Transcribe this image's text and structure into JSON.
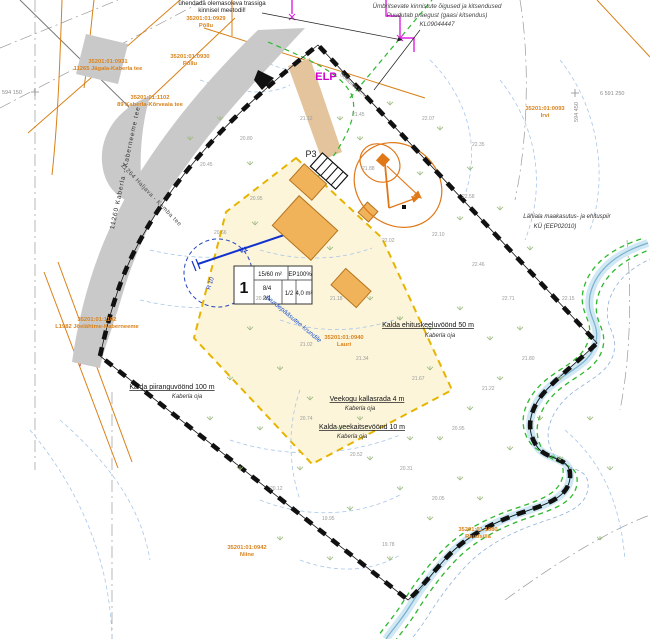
{
  "plan": {
    "colors": {
      "boundary": "#111111",
      "road_fill": "#c9c9c9",
      "building": "#f0b35a",
      "building_stroke": "#b5741f",
      "hoonestusala_fill": "#fcf5da",
      "hoonestusala_border": "#e6b400",
      "water": "#7ab0cc",
      "water_band": "#cfe8f4",
      "utility_green": "#2db82d",
      "cable_magenta": "#e020e0",
      "cadastral_orange": "#d9821c",
      "zone_red": "#cc2222",
      "connection_blue": "#1133cc"
    },
    "notes": {
      "top_l1": "ühendada olemasoleva trassiga",
      "top_l2": "kinnisel meetodil!",
      "right_l1": "Ümbritsevate kinnistute õigused ja kitsendused",
      "right_l2": "Puudutab praegust (gaasi kitsendus)",
      "right_l3": "KL09044447"
    },
    "labels": {
      "elp": "ELP",
      "p3": "P3",
      "v1": "V1",
      "r10": "R 10",
      "juurdepaas": "Juurdepääsutee krundile",
      "soidutee": "Sõidutee serv",
      "lahiala_l1": "Lähiala maakasutus- ja ehituspiir",
      "lahiala_l2": "KÜ (EEP02010)"
    },
    "roads": {
      "vertical": "11260 Kaberla - Kaberneeme tee",
      "diagonal": "11264 Haljava - Kemba tee"
    },
    "zones": [
      {
        "title": "Kalda piiranguvöönd 100 m",
        "sub": "Kaberla oja"
      },
      {
        "title": "Kalda ehituskeeluvöönd 50 m",
        "sub": "Kaberla oja"
      },
      {
        "title": "Veekogu kallasrada 4 m",
        "sub": "Kaberla oja"
      },
      {
        "title": "Kalda veekaitsevöönd 10 m",
        "sub": "Kaberla oja"
      }
    ],
    "cadastral": [
      {
        "line1": "35201:01:0931",
        "line2": "11265 Jägala-Kaberla tee"
      },
      {
        "line1": "35201:01:0929",
        "line2": "Põllu"
      },
      {
        "line1": "35201:01:0930",
        "line2": "Põllu"
      },
      {
        "line1": "35201:01:1102",
        "line2": "89 Kaberla-Kõrveaia tee"
      },
      {
        "line1": "35201:01:1102",
        "line2": "L1982 Jõelähtme-Kaberneeme"
      },
      {
        "line1": "35201:01:0942",
        "line2": "Niine"
      },
      {
        "line1": "35201:01:0093",
        "line2": "Irvi"
      },
      {
        "line1": "35201:01:1080",
        "line2": "Raudsilla"
      },
      {
        "line1": "35201:01:0940",
        "line2": "Lauri"
      }
    ],
    "coords": {
      "x_right": "6 591 250",
      "y_right": "594 450",
      "y_left": "594 150"
    },
    "plot_table": {
      "pos": "1",
      "area": "15/60 m²",
      "ep": "EP100%",
      "v1": "8/4",
      "v2": "2/1",
      "v3": "1/2",
      "v4": "4,0 m²"
    },
    "elevations": [
      {
        "x": 300,
        "y": 120,
        "v": "21.12"
      },
      {
        "x": 352,
        "y": 116,
        "v": "21.45"
      },
      {
        "x": 422,
        "y": 120,
        "v": "22.07"
      },
      {
        "x": 472,
        "y": 146,
        "v": "22.35"
      },
      {
        "x": 362,
        "y": 170,
        "v": "21.88"
      },
      {
        "x": 432,
        "y": 236,
        "v": "22.10"
      },
      {
        "x": 472,
        "y": 266,
        "v": "22.46"
      },
      {
        "x": 502,
        "y": 300,
        "v": "22.71"
      },
      {
        "x": 250,
        "y": 200,
        "v": "20.95"
      },
      {
        "x": 214,
        "y": 234,
        "v": "20.66"
      },
      {
        "x": 256,
        "y": 300,
        "v": "20.88"
      },
      {
        "x": 300,
        "y": 346,
        "v": "21.02"
      },
      {
        "x": 356,
        "y": 360,
        "v": "21.34"
      },
      {
        "x": 412,
        "y": 380,
        "v": "21.67"
      },
      {
        "x": 300,
        "y": 420,
        "v": "20.74"
      },
      {
        "x": 350,
        "y": 456,
        "v": "20.52"
      },
      {
        "x": 400,
        "y": 470,
        "v": "20.31"
      },
      {
        "x": 452,
        "y": 430,
        "v": "20.95"
      },
      {
        "x": 482,
        "y": 390,
        "v": "21.22"
      },
      {
        "x": 270,
        "y": 490,
        "v": "20.12"
      },
      {
        "x": 322,
        "y": 520,
        "v": "19.95"
      },
      {
        "x": 382,
        "y": 546,
        "v": "19.78"
      },
      {
        "x": 432,
        "y": 500,
        "v": "20.05"
      },
      {
        "x": 522,
        "y": 360,
        "v": "21.80"
      },
      {
        "x": 562,
        "y": 300,
        "v": "22.15"
      },
      {
        "x": 200,
        "y": 166,
        "v": "20.45"
      },
      {
        "x": 240,
        "y": 140,
        "v": "20.80"
      },
      {
        "x": 382,
        "y": 242,
        "v": "22.02"
      },
      {
        "x": 462,
        "y": 198,
        "v": "22.58"
      },
      {
        "x": 330,
        "y": 300,
        "v": "21.18"
      }
    ]
  }
}
